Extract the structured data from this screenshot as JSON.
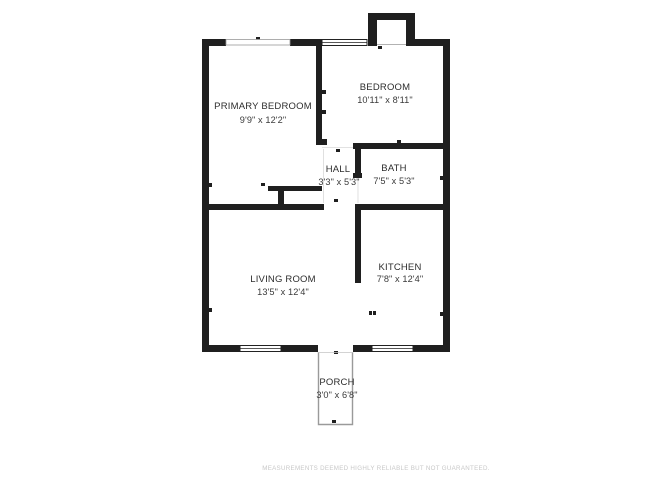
{
  "title": "Floor plan",
  "rooms": [
    {
      "id": "primary-bedroom",
      "name": "PRIMARY BEDROOM",
      "dims": "9'9\" x 12'2\""
    },
    {
      "id": "bedroom",
      "name": "BEDROOM",
      "dims": "10'11\" x 8'11\""
    },
    {
      "id": "hall",
      "name": "HALL",
      "dims": "3'3\" x 5'3\""
    },
    {
      "id": "bath",
      "name": "BATH",
      "dims": "7'5\" x 5'3\""
    },
    {
      "id": "living-room",
      "name": "LIVING ROOM",
      "dims": "13'5\" x 12'4\""
    },
    {
      "id": "kitchen",
      "name": "KITCHEN",
      "dims": "7'8\" x 12'4\""
    },
    {
      "id": "porch",
      "name": "PORCH",
      "dims": "3'0\" x 6'8\""
    }
  ],
  "disclaimer": "MEASUREMENTS DEEMED HIGHLY RELIABLE BUT NOT GUARANTEED.",
  "colors": {
    "wall": "#1f1f1f",
    "room_label": "#2d2d2d",
    "porch_outline": "#9a9a9a",
    "window_frame": "#222222",
    "opening_line": "#d8d8d8",
    "disclaimer": "#c8c8c8",
    "background": "#ffffff"
  }
}
